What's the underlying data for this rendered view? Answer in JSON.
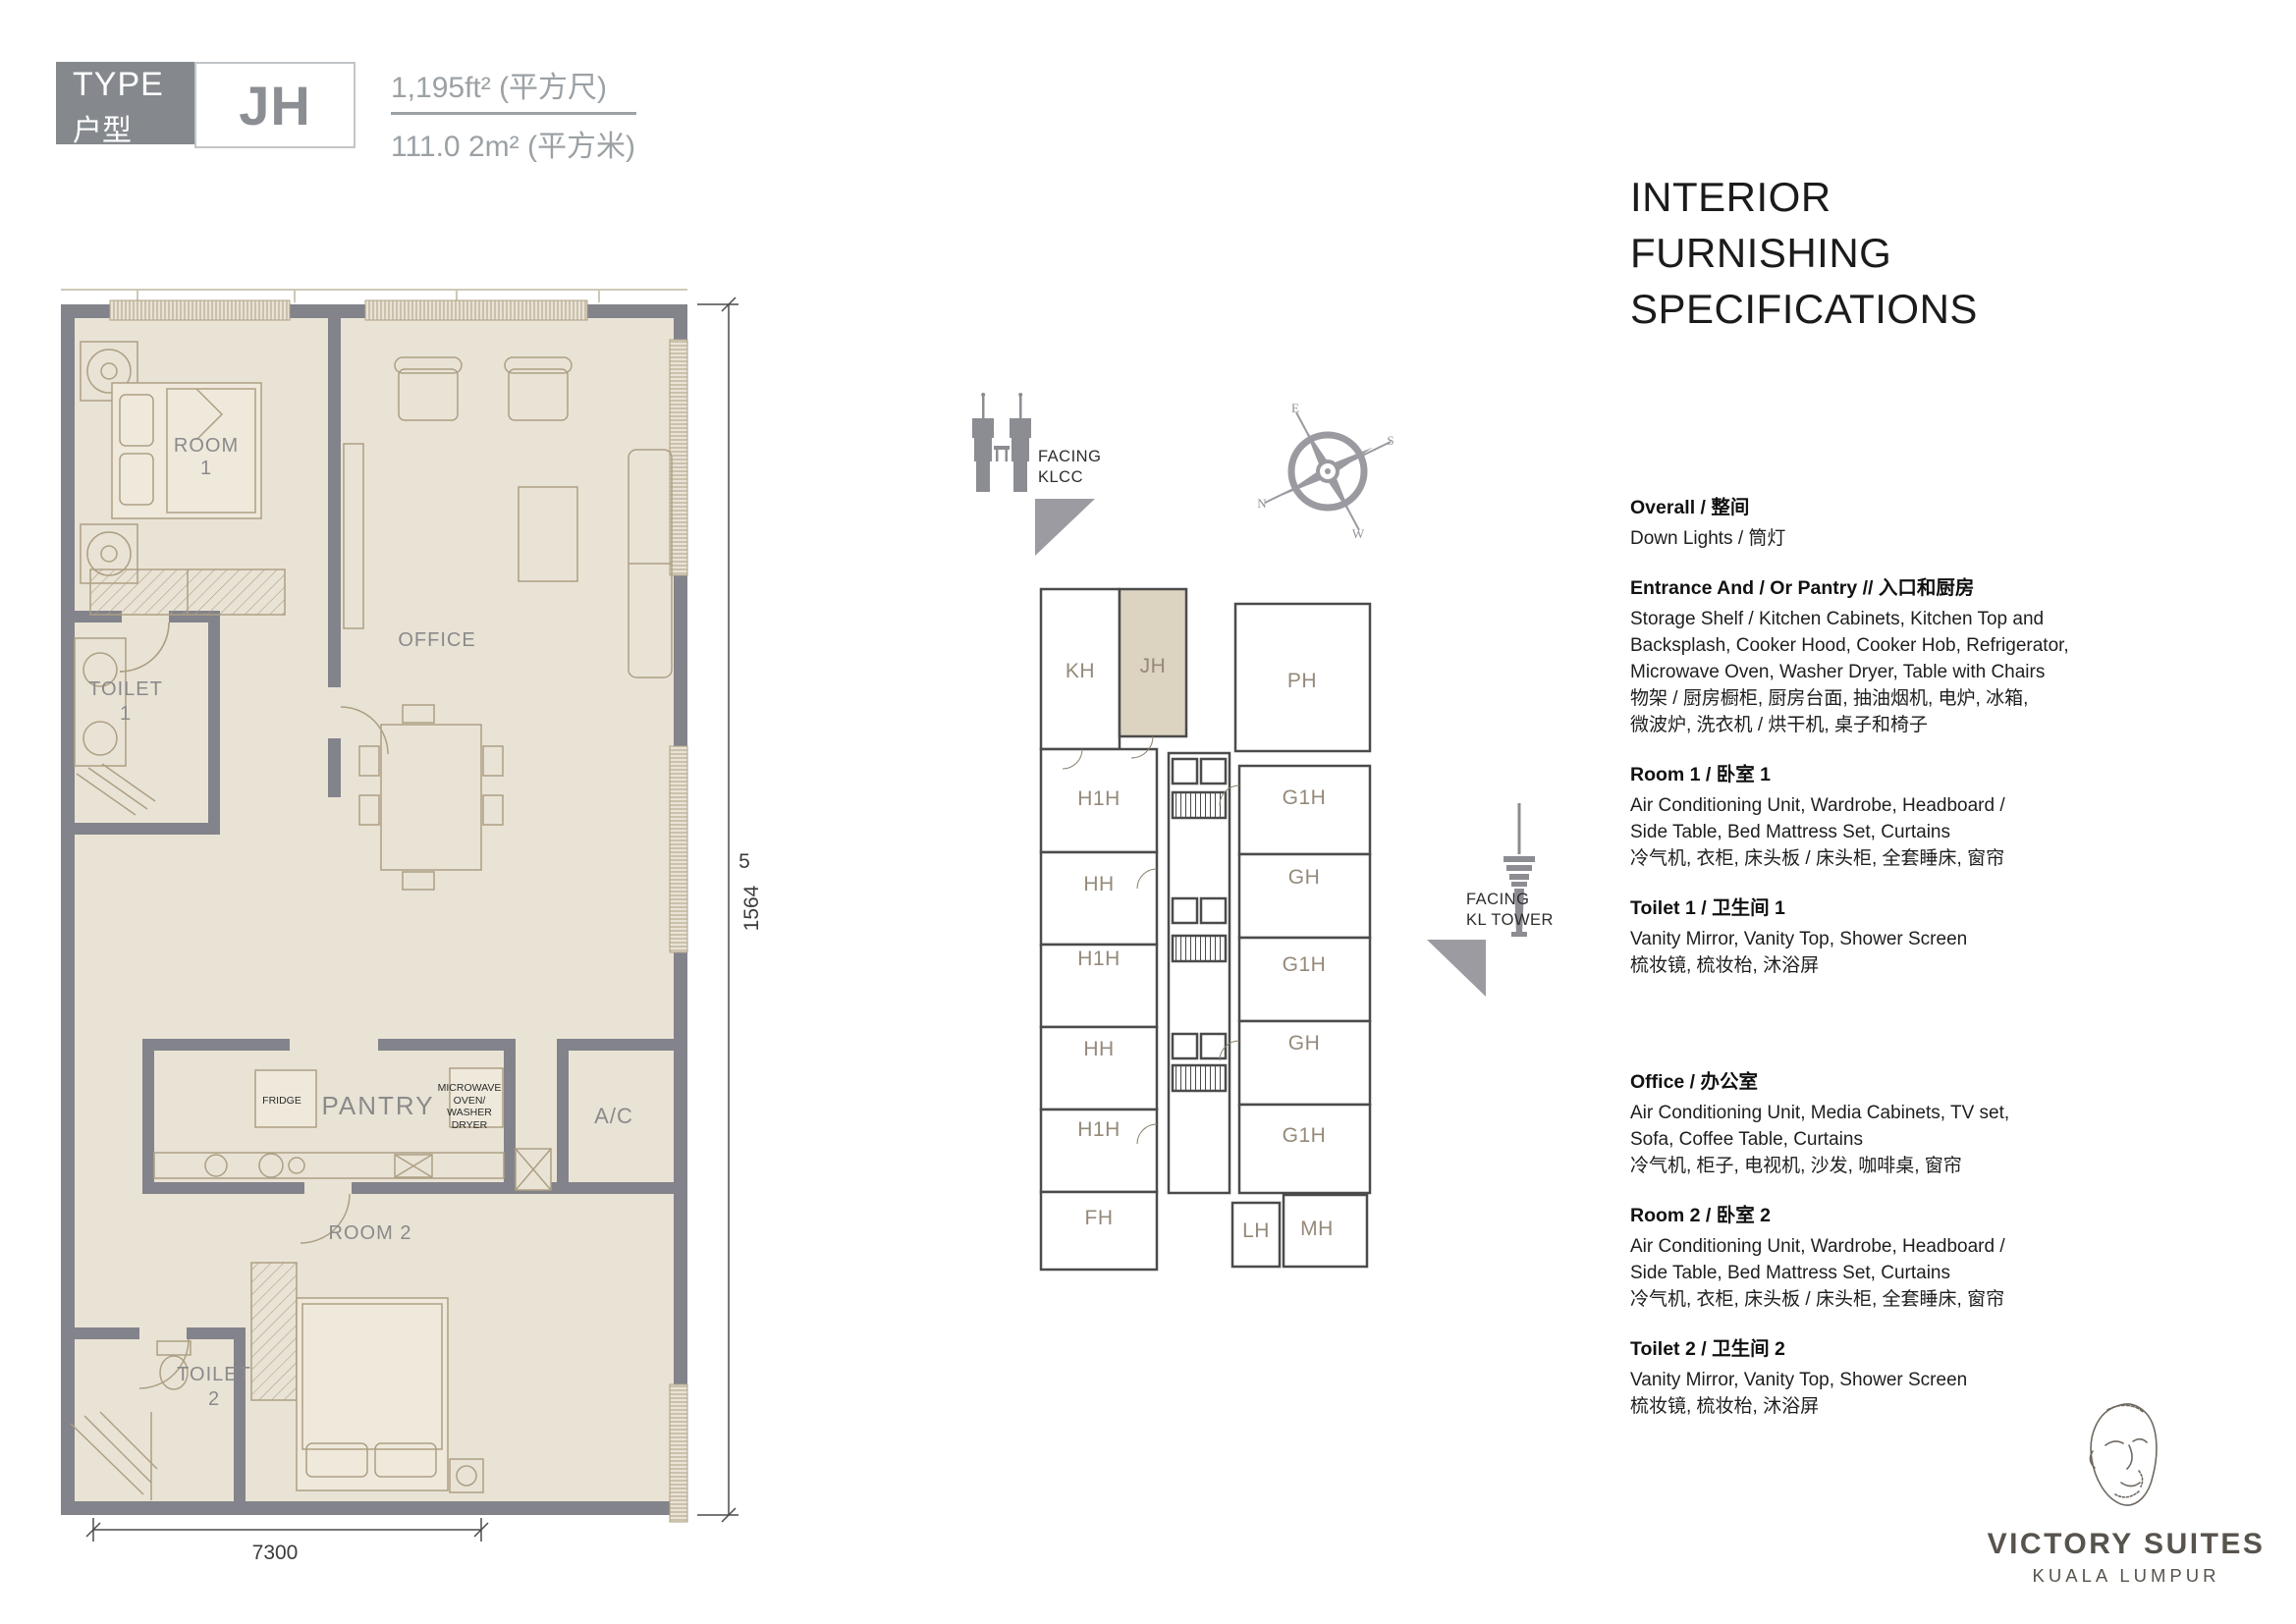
{
  "badge": {
    "type_en": "TYPE",
    "type_zh": "户型",
    "unit": "JH"
  },
  "area": {
    "imperial": "1,195ft² (平方尺)",
    "metric": "111.0 2m² (平方米)"
  },
  "floorplan": {
    "labels": {
      "room1": "ROOM 1",
      "office": "OFFICE",
      "toilet1": "TOILET\n1",
      "pantry": "PANTRY",
      "fridge": "FRIDGE",
      "microwave": "MICROWAVE\nOVEN/\nWASHER\nDRYER",
      "ac": "A/C",
      "room2": "ROOM 2",
      "toilet2": "TOILET\n2"
    },
    "dimensions": {
      "width": "7300",
      "height": "1564",
      "height_suffix": "5"
    }
  },
  "keyplan": {
    "units": {
      "kh": "KH",
      "jh": "JH",
      "ph": "PH",
      "h1h": "H1H",
      "hh": "HH",
      "g1h": "G1H",
      "gh": "GH",
      "fh": "FH",
      "lh": "LH",
      "mh": "MH"
    },
    "facing_klcc": "FACING\nKLCC",
    "facing_kl_tower": "FACING\nKL TOWER"
  },
  "compass": {
    "n": "N",
    "e": "E",
    "s": "S",
    "w": "W"
  },
  "specs": {
    "title": "INTERIOR\nFURNISHING\nSPECIFICATIONS",
    "sections": [
      {
        "heading": "Overall / 整间",
        "body": "Down Lights / 筒灯"
      },
      {
        "heading": "Entrance And / Or Pantry // 入口和厨房",
        "body": "Storage Shelf / Kitchen Cabinets, Kitchen Top and\nBacksplash, Cooker Hood, Cooker Hob, Refrigerator,\nMicrowave Oven, Washer Dryer, Table with Chairs\n物架 / 厨房橱柜, 厨房台面, 抽油烟机, 电炉, 冰箱,\n微波炉, 洗衣机 / 烘干机, 桌子和椅子"
      },
      {
        "heading": "Room 1 / 卧室 1",
        "body": "Air Conditioning Unit, Wardrobe, Headboard /\nSide Table, Bed Mattress Set, Curtains\n冷气机, 衣柜, 床头板 / 床头柜, 全套睡床, 窗帘"
      },
      {
        "heading": "Toilet 1 / 卫生间 1",
        "body": "Vanity Mirror, Vanity Top, Shower Screen\n梳妆镜, 梳妆枱, 沐浴屏"
      },
      {
        "heading": "Office / 办公室",
        "body": "Air Conditioning Unit, Media Cabinets, TV set,\nSofa, Coffee Table, Curtains\n冷气机, 柜子, 电视机, 沙发, 咖啡桌, 窗帘"
      },
      {
        "heading": "Room 2 / 卧室 2",
        "body": "Air Conditioning Unit, Wardrobe, Headboard /\nSide Table, Bed Mattress Set, Curtains\n冷气机, 衣柜, 床头板 / 床头柜, 全套睡床, 窗帘"
      },
      {
        "heading": "Toilet 2 / 卫生间 2",
        "body": "Vanity Mirror, Vanity Top, Shower Screen\n梳妆镜, 梳妆枱, 沐浴屏"
      }
    ]
  },
  "logo": {
    "brand": "VICTORY SUITES",
    "city": "KUALA LUMPUR"
  },
  "colors": {
    "wall": "#83838b",
    "floor": "#e9e3d6",
    "keyplan_wall": "#4b4b4b",
    "highlight_unit": "#dcd3c1",
    "badge": "#85898d",
    "accent_gray": "#9b9ba1"
  }
}
